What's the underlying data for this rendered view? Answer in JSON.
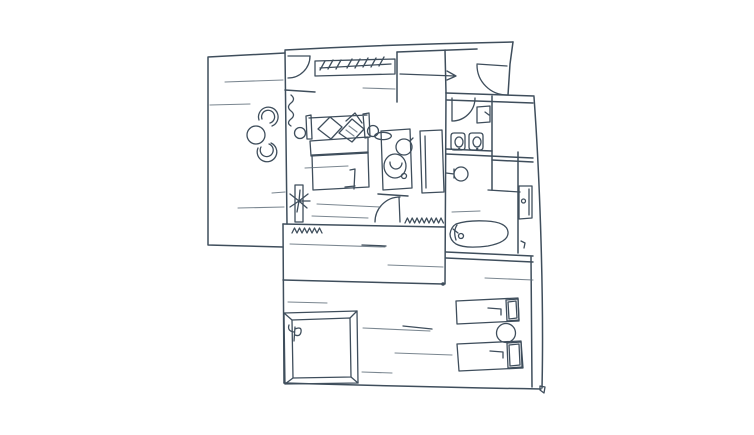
{
  "canvas": {
    "width": 754,
    "height": 435,
    "background": "#ffffff",
    "ink": "#3f4e5c",
    "ink_light": "#63717d",
    "description": "hand-drawn apartment floor plan sketch"
  },
  "drawing": {
    "elements": [
      {
        "name": "balcony-walls",
        "cls": "w",
        "d": "M285,53 L208,57 L208,245 L283,247"
      },
      {
        "name": "bedroom-left-wall",
        "cls": "w",
        "d": "M285,51 L287,224"
      },
      {
        "name": "bedroom-top-wall-outer",
        "cls": "w",
        "d": "M285,50 Q400,44 513,42"
      },
      {
        "name": "bedroom-top-wall-inner",
        "cls": "w",
        "d": "M397,52 L477,49"
      },
      {
        "name": "bedroom-right-wall-top",
        "cls": "w",
        "d": "M513,42 L510,64 L508,95"
      },
      {
        "name": "corridor-partition-wall",
        "cls": "w",
        "d": "M397,52 L397,102"
      },
      {
        "name": "entry-closet-wall",
        "cls": "w",
        "d": "M445,50 L446,93"
      },
      {
        "name": "wc-block-top-wall",
        "cls": "w",
        "d": "M446,93 L534,96"
      },
      {
        "name": "wc-block-top-wall-inner",
        "cls": "w",
        "d": "M447,100 L533,103"
      },
      {
        "name": "right-outer-wall",
        "cls": "w",
        "d": "M534,97 C540,180 544,300 542,388"
      },
      {
        "name": "wing-left-wall",
        "cls": "w",
        "d": "M446,93 L445,284"
      },
      {
        "name": "wc-partition-wall",
        "cls": "w",
        "d": "M492,96 L492,190"
      },
      {
        "name": "wc-shelf-line",
        "cls": "w",
        "d": "M446,149 L492,151"
      },
      {
        "name": "hall-divider-line",
        "cls": "w",
        "d": "M446,154 L533,158"
      },
      {
        "name": "hall-divider-line-2",
        "cls": "w",
        "d": "M492,160 L533,162"
      },
      {
        "name": "bathroom-inner-wall",
        "cls": "w",
        "d": "M518,152 L518,253"
      },
      {
        "name": "bathroom-bottom-wall",
        "cls": "w",
        "d": "M446,252 Q490,254 533,256"
      },
      {
        "name": "bathroom-bottom-wall-2",
        "cls": "w",
        "d": "M446,258 Q490,260 533,262"
      },
      {
        "name": "bedroom-south-wall",
        "cls": "w",
        "d": "M283,224 L445,227"
      },
      {
        "name": "door-head-wall",
        "cls": "w",
        "d": "M378,194 L408,196"
      },
      {
        "name": "corridor-south-wall",
        "cls": "w",
        "d": "M283,280 Q365,282 443,284"
      },
      {
        "name": "lower-left-wall",
        "cls": "w",
        "d": "M283,224 L284,383"
      },
      {
        "name": "lower-bottom-wall",
        "cls": "w",
        "d": "M284,383 Q420,387 541,389"
      },
      {
        "name": "terrace-inner-wall",
        "cls": "w",
        "d": "M531,257 L532,387"
      },
      {
        "name": "wall-stub-left",
        "cls": "w",
        "d": "M285,90 L315,92"
      },
      {
        "name": "bedroom-door-leaf",
        "cls": "f",
        "d": "M288,56 L310,56"
      },
      {
        "name": "bedroom-door-arc",
        "cls": "f",
        "d": "M310,56 A22,22 0 0 1 288,78"
      },
      {
        "name": "entrance-door-leaf",
        "cls": "f",
        "d": "M477,64 L507,66"
      },
      {
        "name": "entrance-door-arc",
        "cls": "f",
        "d": "M477,65 A30,30 0 0 0 507,95"
      },
      {
        "name": "entry-arrow",
        "cls": "f",
        "d": "M400,74 L455,76 M447,71 L456,76 L447,80"
      },
      {
        "name": "wc-door-leaf",
        "cls": "f",
        "d": "M452,98 L452,121"
      },
      {
        "name": "wc-door-arc",
        "cls": "f",
        "d": "M452,121 A23,23 0 0 0 475,98"
      },
      {
        "name": "hall-door-leaf",
        "cls": "f",
        "d": "M399,197 L400,222"
      },
      {
        "name": "hall-door-arc",
        "cls": "f",
        "d": "M400,197 A25,25 0 0 0 375,222"
      },
      {
        "name": "right-wall-door",
        "cls": "f",
        "d": "M519,186 L532,186 L532,218 L519,219 Z M529,189 L529,215"
      },
      {
        "name": "right-wall-door-handle",
        "cls": "f",
        "d": "M521.5,201 a2,2 0 1 0 4,0 a2,2 0 1 0 -4,0"
      },
      {
        "name": "right-wall-hook",
        "cls": "f",
        "d": "M521,241 l4,2 l-1,5"
      },
      {
        "name": "wardrobe-body",
        "cls": "f",
        "d": "M315,61 L395,59 L395,74 L315,76 Z"
      },
      {
        "name": "wardrobe-rail",
        "cls": "f",
        "d": "M320,68 L391,64"
      },
      {
        "name": "wardrobe-hangers",
        "cls": "f",
        "d": "M325,61 l-5,9 M333,60 l-5,9 M341,60 l-5,9 M352,59 l-5,9 M360,59 l-5,9 M368,58 l-5,9 M376,58 l-5,9 M384,57 l-5,9"
      },
      {
        "name": "balcony-curtain",
        "cls": "f",
        "d": "M291,95 q5,4 0,8 q-5,4 0,8 q5,4 0,8 q-5,4 0,7"
      },
      {
        "name": "shower-curtain",
        "cls": "f",
        "d": "M405,223 l2.4,-5 l2.4,5 l2.4,-5 l2.4,5 l2.4,-5 l2.4,5 l2.4,-5 l2.4,5 l2.4,-5 l2.4,5 l2.4,-5 l2.4,5 l2.4,-5 l2.4,5 l2.4,-5 l2.4,5"
      },
      {
        "name": "balcony-chair-1",
        "cls": "f",
        "d": "M259,120 A9.8,9.8 0 1 1 272,126 M262,119 A6.5,6.5 0 1 1 270,123"
      },
      {
        "name": "balcony-chair-2",
        "cls": "f",
        "d": "M258,148 A9.8,9.8 0 1 0 271,143 M261,147 A6.5,6.5 0 1 0 269,144"
      },
      {
        "name": "balcony-table",
        "cls": "f",
        "d": "M247,135 a9,9 0 1 0 18,0 a9,9 0 1 0 -18,0"
      },
      {
        "name": "bed-headboard",
        "cls": "f",
        "d": "M309,118 L367,115 M306,116 L311,115 L312,139 L307,139 Z M363,114 L369,113 L370,137 L365,138 Z"
      },
      {
        "name": "bed-pillow-1",
        "cls": "f",
        "d": "M318,129 L330,117 L342,127 L331,139 Z"
      },
      {
        "name": "bed-pillow-2",
        "cls": "f",
        "d": "M339,133 L352,119 L364,129 L352,142 Z M346,121 L355,113 L362,123"
      },
      {
        "name": "bed-pillow-hatch",
        "cls": "t",
        "d": "M349,126 l8,6 M346,130 l8,6"
      },
      {
        "name": "bed-sheet",
        "cls": "f",
        "d": "M310,141 L368,137 L368,153 L311,156 Z"
      },
      {
        "name": "bed-body",
        "cls": "f",
        "d": "M312,155 L368,152 L369,187 L313,190 Z"
      },
      {
        "name": "bed-fold",
        "cls": "f",
        "d": "M350,170 L355,169 L354,189 M345,187 l10,-1"
      },
      {
        "name": "nightstand-left",
        "cls": "f",
        "d": "M294.5,133 a5.5,5.5 0 1 0 11,0 a5.5,5.5 0 1 0 -11,0"
      },
      {
        "name": "nightstand-right",
        "cls": "f",
        "d": "M367.5,131 a5.5,5.5 0 1 0 11,0 a5.5,5.5 0 1 0 -11,0"
      },
      {
        "name": "vanity-cabinet",
        "cls": "f",
        "d": "M381,131 L410,129 L412,188 L383,190 Z"
      },
      {
        "name": "vanity-sink",
        "cls": "f",
        "d": "M396,147 a8,8 0 1 0 16,0 a8,8 0 1 0 -16,0 M410,141 l3,-3"
      },
      {
        "name": "vanity-soap-dish",
        "cls": "f",
        "d": "M375,137 a8,3.5 0 1 0 16,-2 a8,3.5 0 1 0 -16,2"
      },
      {
        "name": "toilet-bowl",
        "cls": "f",
        "d": "M384,166 a11,12 0 1 0 22,0 a11,12 0 1 0 -22,0 M390,162 a6,6.5 0 1 0 12,1"
      },
      {
        "name": "toilet-button",
        "cls": "f",
        "d": "M401.5,176 a2.5,2.5 0 1 0 5,0 a2.5,2.5 0 1 0 -5,0"
      },
      {
        "name": "shower-stall",
        "cls": "f",
        "d": "M420,131 L442,130 L444,192 L422,193 Z M425,136 L426,188"
      },
      {
        "name": "wc-cistern",
        "cls": "f",
        "d": "M477,107 L490,106 L490,122 L477,123 Z M485,112 l4,3"
      },
      {
        "name": "wc-basin-1",
        "cls": "f",
        "d": "M454,133 l8,0 q3,0 3,3 l0,11 q0,3 -3,3 l-8,0 q-3,0 -3,-3 l0,-11 q0,-3 3,-3 Z M455,142 a4,5 0 1 0 8,0 a4,5 0 1 0 -8,0"
      },
      {
        "name": "wc-basin-2",
        "cls": "f",
        "d": "M472,133 l8,0 q3,0 3,3 l0,11 q0,3 -3,3 l-8,0 q-3,0 -3,-3 l0,-11 q0,-3 3,-3 Z M473,142 a4,5 0 1 0 8,0 a4,5 0 1 0 -8,0"
      },
      {
        "name": "wc-sink-round",
        "cls": "f",
        "d": "M454,174 a7,7 0 1 0 14,0 a7,7 0 1 0 -14,0 M446,173 l8,1 M454,169 l0,9"
      },
      {
        "name": "bath-bench-line",
        "cls": "f",
        "d": "M488,190 L520,192"
      },
      {
        "name": "bathtub",
        "cls": "f",
        "d": "M456,224 Q468,220 486,221 Q507,222 508,232 Q509,242 488,246 Q465,249 456,244 Q450,240 450,234 Q451,227 456,224 Z"
      },
      {
        "name": "bathtub-chord",
        "cls": "f",
        "d": "M457,225 q-4,6 -1,15"
      },
      {
        "name": "bathtub-drain",
        "cls": "f",
        "d": "M458.5,236 a2.5,2.5 0 1 0 5,0 a2.5,2.5 0 1 0 -5,0 M458,233 l-5,-4"
      },
      {
        "name": "plant-console",
        "cls": "f",
        "d": "M295,185 L303,185 L303,222 L295,222 Z"
      },
      {
        "name": "plant",
        "cls": "f",
        "d": "M299,201 l-9,-7 M299,201 l-9,6 M299,201 l9,-7 M299,201 l8,7 M299,201 l1,-11 M299,201 l-2,11 M299,201 l11,0"
      },
      {
        "name": "console-fringe",
        "cls": "f",
        "d": "M292,233 l2.5,-5 l2.5,5 l2.5,-5 l2.5,5 l2.5,-5 l2.5,5 l2.5,-5 l2.5,5 l2.5,-5 l2.5,5 l2.5,-5 l2.5,5"
      },
      {
        "name": "square-table-outer",
        "cls": "f",
        "d": "M284,313 L357,311 L358,383 L285,384 Z"
      },
      {
        "name": "square-table-inner",
        "cls": "f",
        "d": "M292,320 L350,318 L351,377 L293,378 Z"
      },
      {
        "name": "square-table-bevels",
        "cls": "f",
        "d": "M284,313 L292,320 M357,311 L350,318 M358,383 L351,377 M285,384 L293,378"
      },
      {
        "name": "square-table-sprout",
        "cls": "f",
        "d": "M294,341 L295,327 M295,329 q7,-3 6,3 q-1,5 -6,3 M294,332 q-7,-1 -5,-7"
      },
      {
        "name": "lounger-1",
        "cls": "f",
        "d": "M456,301 L518,298 L519,321 L457,324 Z"
      },
      {
        "name": "lounger-1-headrest",
        "cls": "f",
        "d": "M506,300 L518,299 L519,320 L507,321 Z M508,302 L516,301 L517,318 L509,319 Z"
      },
      {
        "name": "lounger-1-mark",
        "cls": "f",
        "d": "M488,308 l13,1 l0,6"
      },
      {
        "name": "terrace-table",
        "cls": "f",
        "d": "M496.5,333 a9.5,9.5 0 1 0 19,0 a9.5,9.5 0 1 0 -19,0"
      },
      {
        "name": "lounger-2",
        "cls": "f",
        "d": "M457,344 L521,341 L523,368 L459,371 Z"
      },
      {
        "name": "lounger-2-headrest",
        "cls": "f",
        "d": "M507,343 L521,342 L522,367 L508,368 Z M509,345 L519,344 L520,365 L510,366 Z"
      },
      {
        "name": "lounger-2-mark",
        "cls": "f",
        "d": "M490,351 l13,1 l0,6"
      },
      {
        "name": "corner-pin",
        "cls": "f",
        "d": "M540,386 l5,1 l-1,6 l-4,-3 Z"
      },
      {
        "name": "balcony-sketch-line-1",
        "cls": "t",
        "d": "M225,82 L283,80"
      },
      {
        "name": "balcony-sketch-line-2",
        "cls": "t",
        "d": "M210,105 L250,104"
      },
      {
        "name": "balcony-sketch-line-3",
        "cls": "t",
        "d": "M238,208 L284,207"
      },
      {
        "name": "balcony-sketch-line-4",
        "cls": "t",
        "d": "M272,193 L285,192"
      },
      {
        "name": "bedroom-sketch-line-1",
        "cls": "t",
        "d": "M305,168 L348,166"
      },
      {
        "name": "bedroom-sketch-line-2",
        "cls": "t",
        "d": "M317,204 L380,207"
      },
      {
        "name": "bedroom-sketch-line-3",
        "cls": "t",
        "d": "M312,216 L368,218"
      },
      {
        "name": "corridor-sketch-line",
        "cls": "t",
        "d": "M363,88 L395,89"
      },
      {
        "name": "hall-sketch-line-1",
        "cls": "t",
        "d": "M290,244 L385,247"
      },
      {
        "name": "hall-sketch-line-1b",
        "cls": "f",
        "d": "M362,245 L386,246"
      },
      {
        "name": "hall-sketch-line-2",
        "cls": "t",
        "d": "M388,265 L443,267"
      },
      {
        "name": "bath-sketch-line",
        "cls": "t",
        "d": "M452,212 L480,211"
      },
      {
        "name": "terrace-sketch-line",
        "cls": "t",
        "d": "M485,278 L533,280"
      },
      {
        "name": "lower-sketch-line-1",
        "cls": "t",
        "d": "M288,302 L327,303"
      },
      {
        "name": "lower-sketch-line-2",
        "cls": "t",
        "d": "M363,328 L430,331"
      },
      {
        "name": "lower-sketch-line-2b",
        "cls": "f",
        "d": "M403,326 L432,329"
      },
      {
        "name": "lower-sketch-line-3",
        "cls": "t",
        "d": "M395,353 L452,355"
      },
      {
        "name": "lower-sketch-line-4",
        "cls": "t",
        "d": "M362,372 L392,373"
      },
      {
        "name": "corridor-wall-dot",
        "cls": "d",
        "d": "M441.2,284 a1.8,1.8 0 1 0 3.6,0 a1.8,1.8 0 1 0 -3.6,0 Z"
      },
      {
        "name": "basin-1-dot",
        "cls": "d",
        "d": "M458,149 a1.2,1.2 0 1 0 2.4,0 a1.2,1.2 0 1 0 -2.4,0 Z"
      },
      {
        "name": "basin-2-dot",
        "cls": "d",
        "d": "M476,149 a1.2,1.2 0 1 0 2.4,0 a1.2,1.2 0 1 0 -2.4,0 Z"
      }
    ]
  }
}
